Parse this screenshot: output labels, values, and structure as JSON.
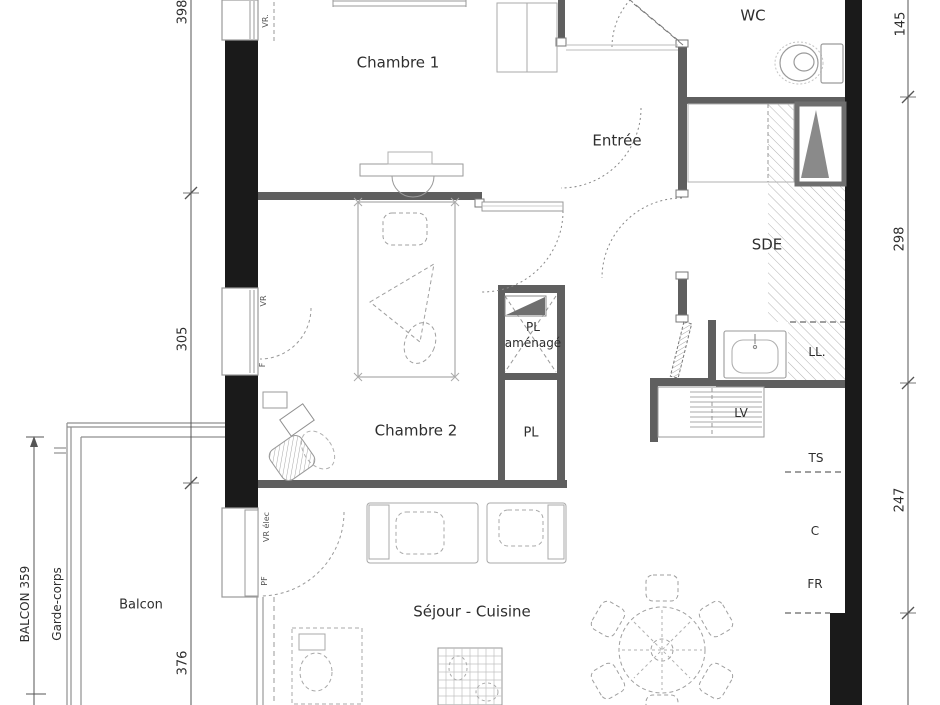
{
  "plan": {
    "rooms": {
      "chambre1": "Chambre 1",
      "chambre2": "Chambre 2",
      "entree": "Entrée",
      "wc": "WC",
      "sde": "SDE",
      "pl_amenage_line1": "PL",
      "pl_amenage_line2": "aménagé",
      "pl": "PL",
      "balcon": "Balcon",
      "sejour_cuisine": "Séjour - Cuisine"
    },
    "appliances": {
      "ll": "LL.",
      "lv": "LV",
      "ts": "TS",
      "c": "C",
      "fr": "FR"
    },
    "dimensions": {
      "left_top": "398",
      "left_mid": "305",
      "left_bottom": "376",
      "balcon_length": "BALCON 359",
      "garde_corps": "Garde-corps",
      "right_top": "145",
      "right_mid": "298",
      "right_bottom": "247"
    },
    "windows": {
      "vr_top": "VR.",
      "vr_ch2": "VR",
      "f_ch2": "F",
      "vr_elec": "VR élec",
      "pf": "PF"
    },
    "colors": {
      "wall_black": "#1a1a1a",
      "wall_gray": "#5f5f5f",
      "dim_line": "#555555",
      "furniture": "#9a9a9a",
      "text": "#2e2e2e",
      "background": "#ffffff"
    }
  }
}
